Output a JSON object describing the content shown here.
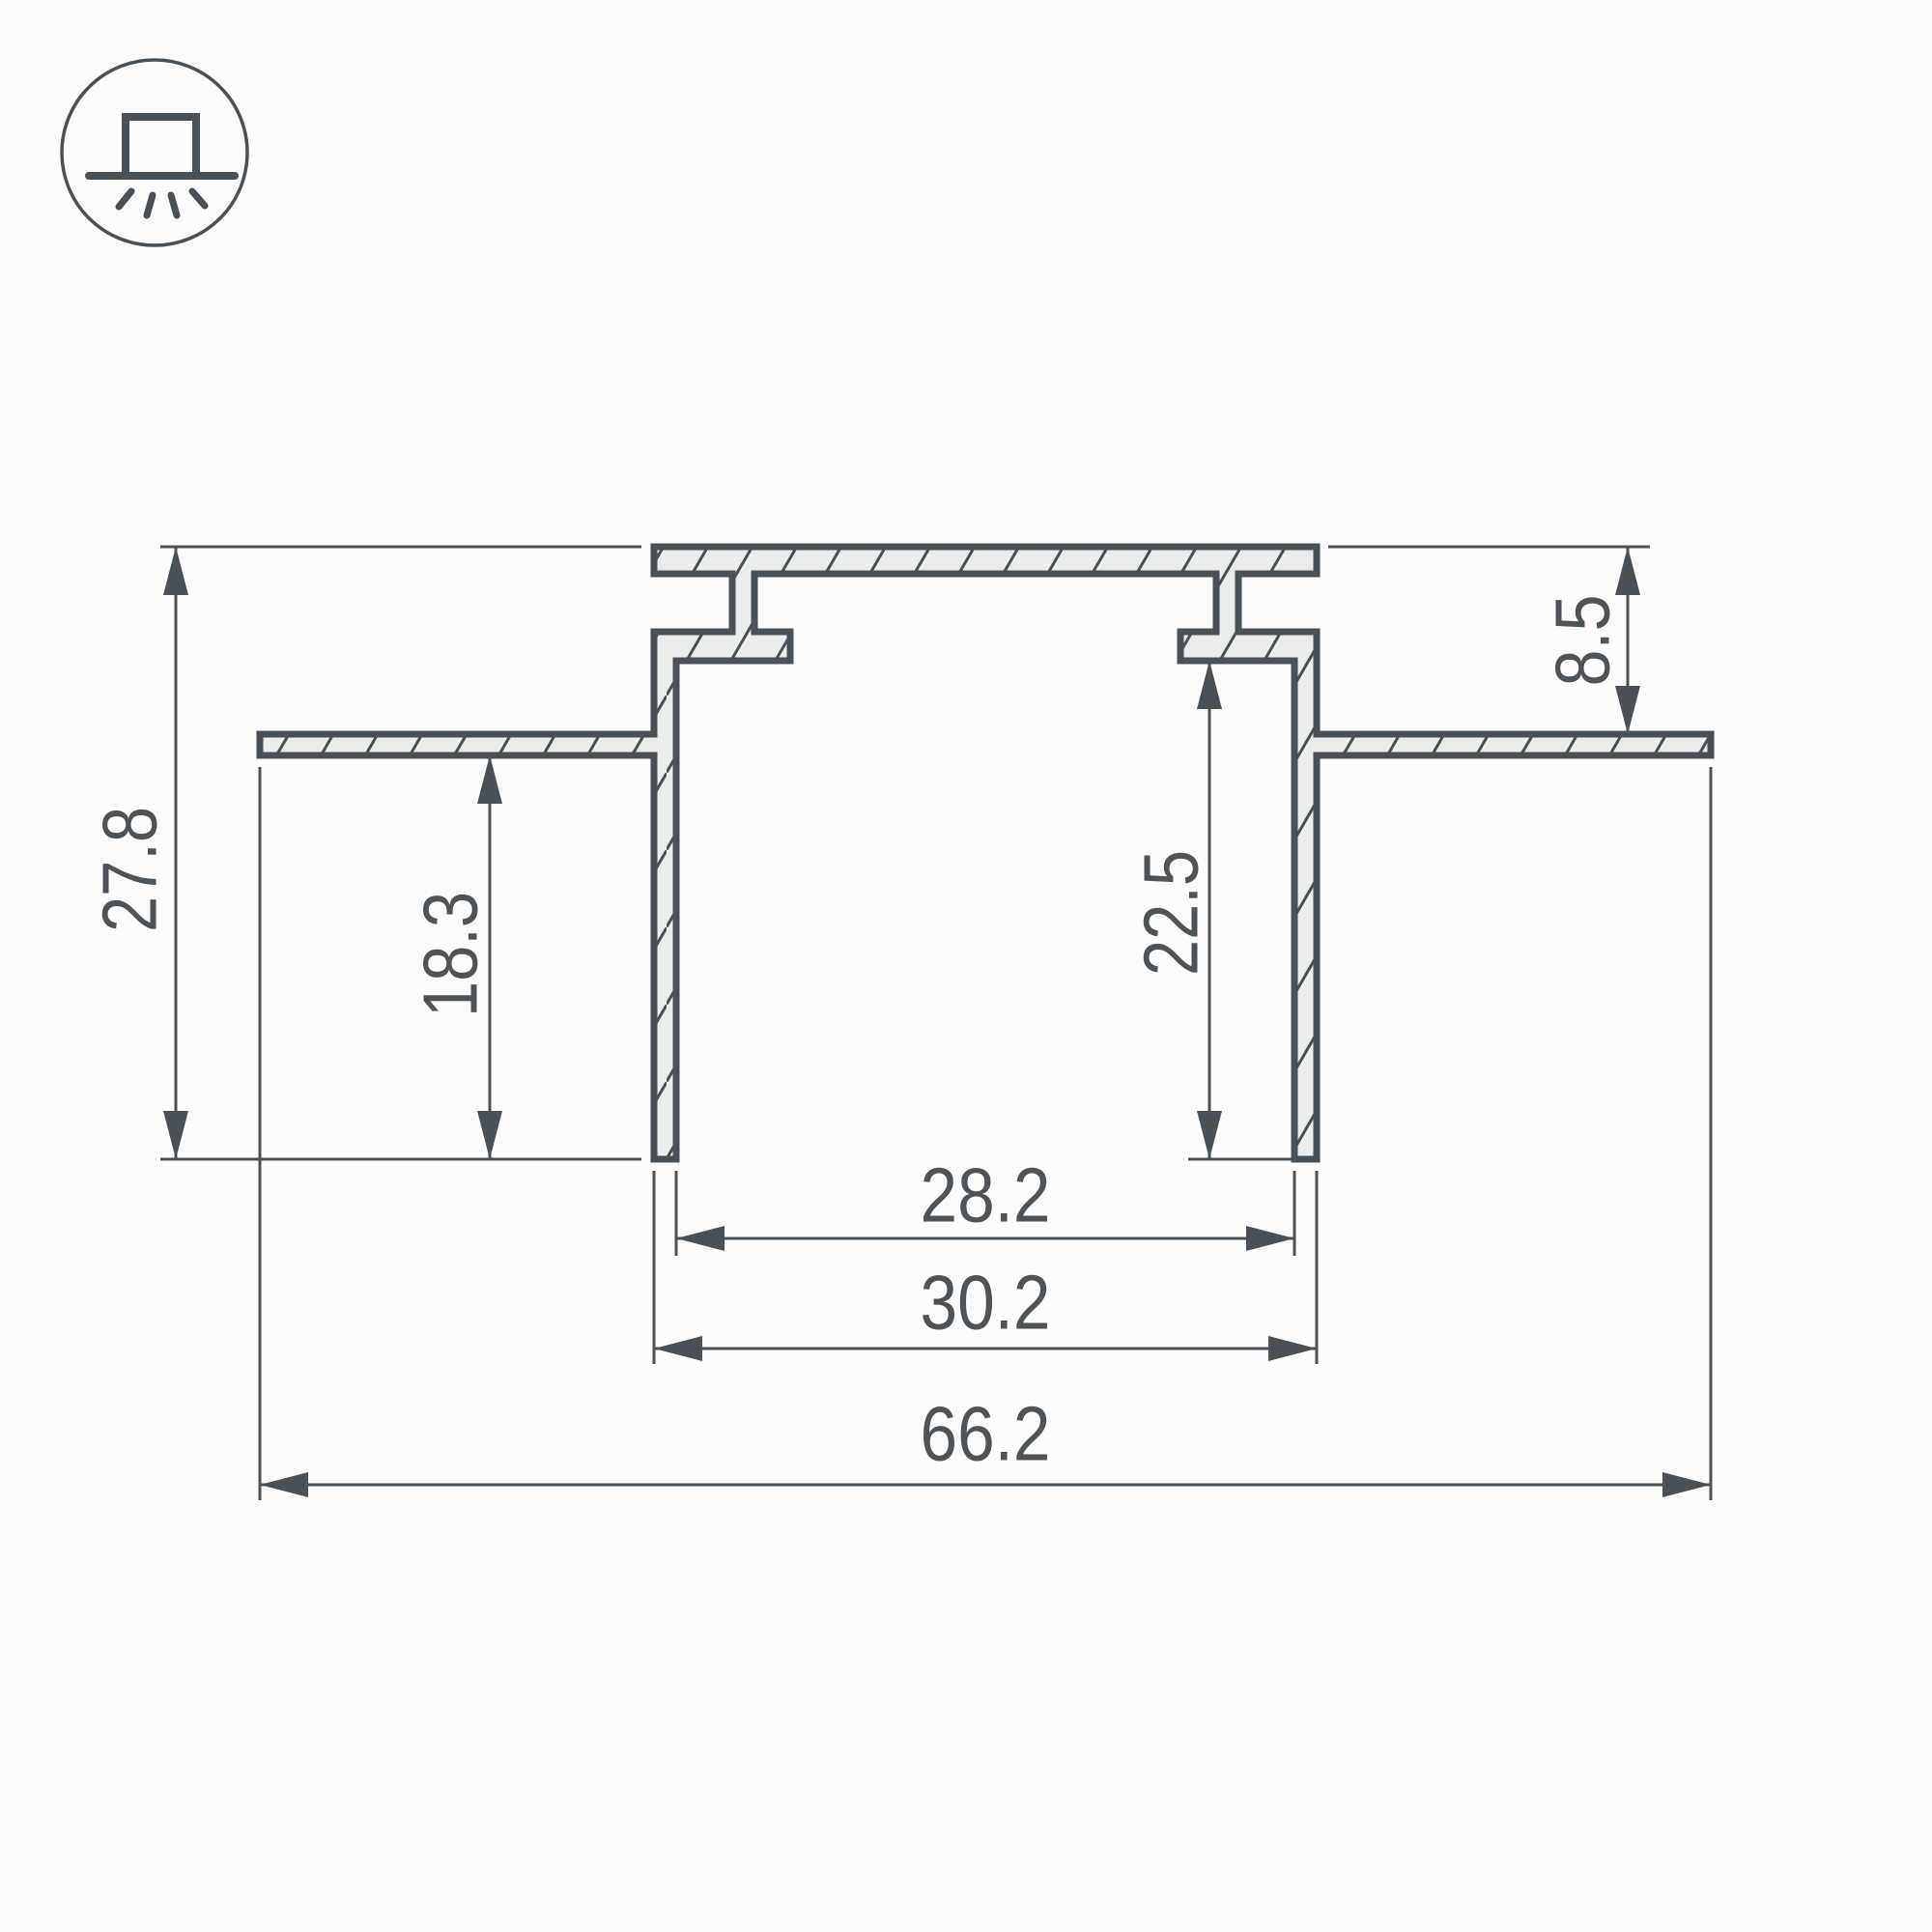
{
  "icon": {
    "name": "recessed-light-icon",
    "description": "surface with recessed luminaire shining down"
  },
  "drawing": {
    "title": "LED profile cross-section",
    "dimensions": {
      "total_height": "27.8",
      "side_depth": "18.3",
      "cavity_depth": "22.5",
      "top_recess": "8.5",
      "opening_width": "28.2",
      "body_width": "30.2",
      "total_width": "66.2"
    },
    "colors": {
      "line": "#4a5156",
      "profile_fill": "#ebecec",
      "text": "#4d5357",
      "background": "#fbfbfb"
    }
  }
}
